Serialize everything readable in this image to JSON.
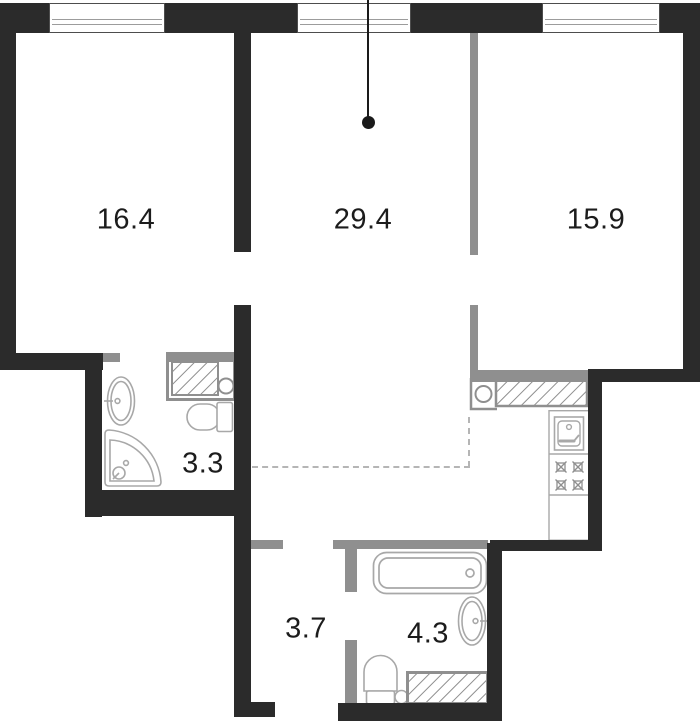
{
  "plan_title": "apartment-floor-plan",
  "areas": [
    "16.4",
    "29.4",
    "15.9",
    "3.3",
    "3.7",
    "4.3"
  ],
  "fixtures": [
    "sink",
    "washing-machine",
    "toilet",
    "shower",
    "kitchen-counter",
    "kitchen-sink",
    "stove",
    "bathtub"
  ],
  "colors": {
    "wall": "#2b2b2b",
    "partition": "#8f8f8f",
    "fixture_outline": "#a8a8a8",
    "background": "#ffffff",
    "label_text": "#1c1c1c"
  }
}
